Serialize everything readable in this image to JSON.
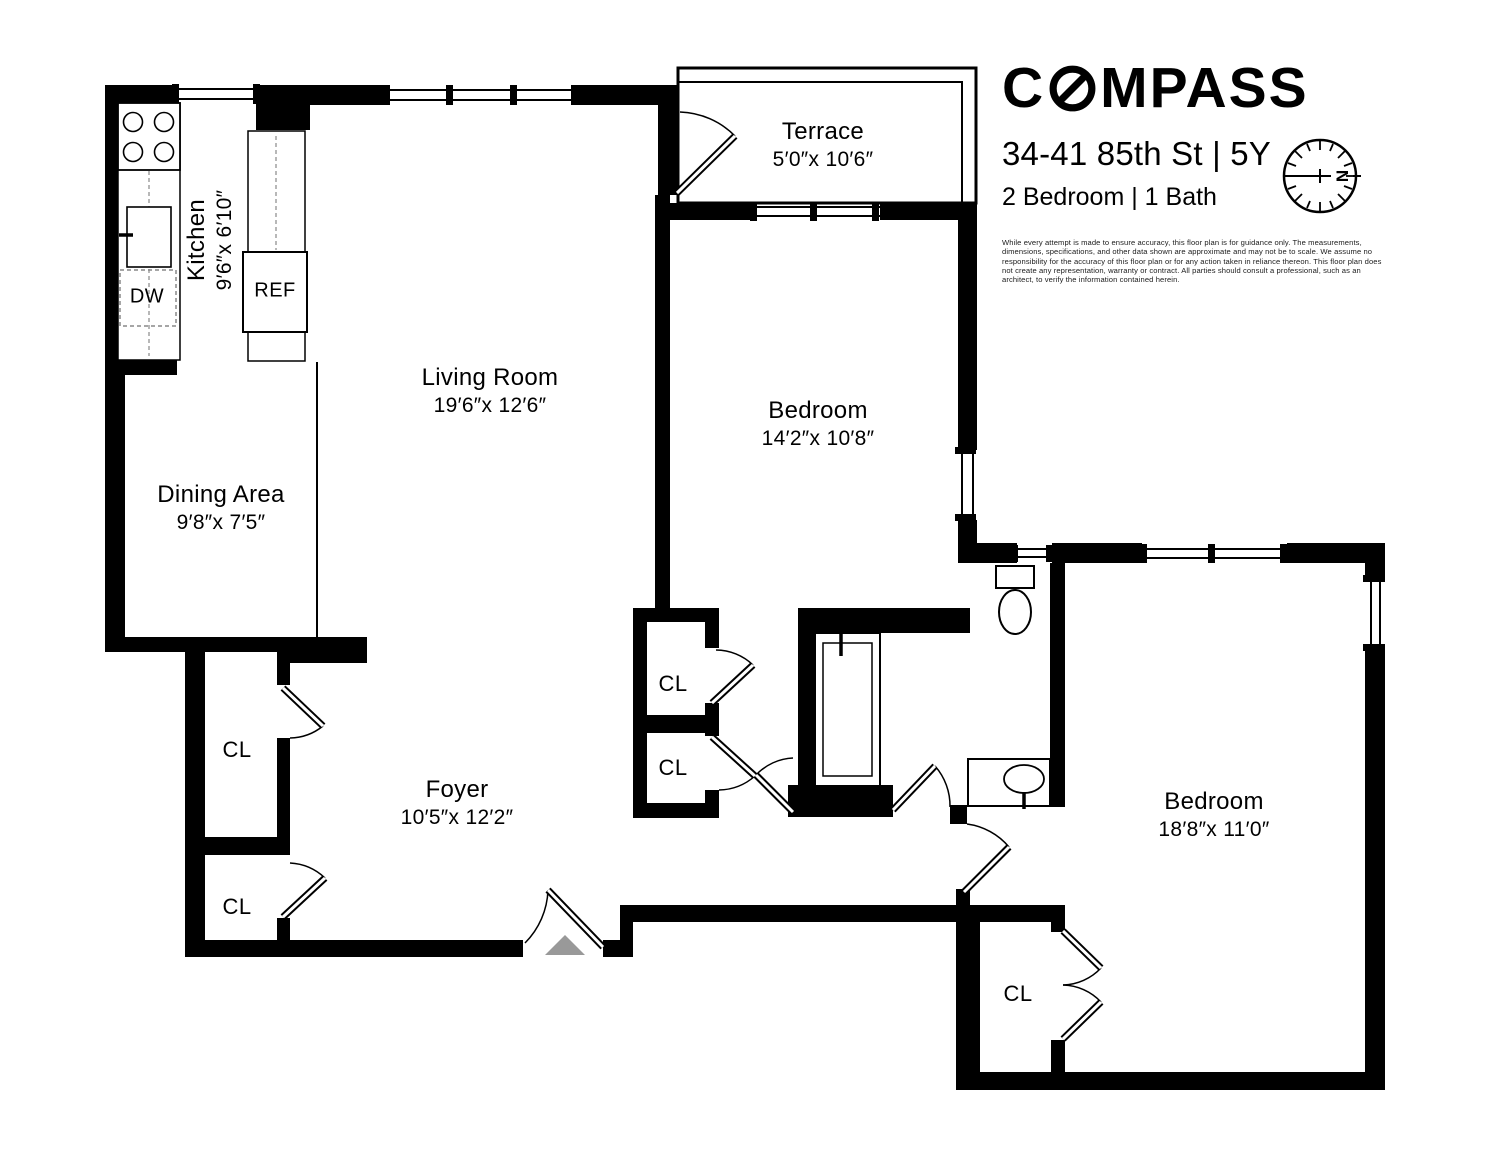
{
  "header": {
    "brand": {
      "pre_o": "C",
      "post_o": "MPASS"
    },
    "address": "34-41 85th St | 5Y",
    "summary": "2 Bedroom | 1 Bath",
    "compass_north_label": "N",
    "disclaimer": "While every attempt is made to ensure accuracy, this floor plan is for guidance only. The measurements, dimensions, specifications, and other data shown are approximate and may not be to scale. We assume no responsibility for the accuracy of this floor plan or for any action taken in reliance thereon. This floor plan does not create any representation, warranty or contract. All parties should consult a professional, such as an architect, to verify the information contained herein."
  },
  "rooms": [
    {
      "name": "Kitchen",
      "dims": "9′6″x 6′10″"
    },
    {
      "name": "Dining Area",
      "dims": "9′8″x 7′5″"
    },
    {
      "name": "Living Room",
      "dims": "19′6″x 12′6″"
    },
    {
      "name": "Terrace",
      "dims": "5′0″x 10′6″"
    },
    {
      "name": "Bedroom",
      "dims": "14′2″x 10′8″"
    },
    {
      "name": "Foyer",
      "dims": "10′5″x 12′2″"
    },
    {
      "name": "Bedroom",
      "dims": "18′8″x 11′0″"
    }
  ],
  "labels": {
    "dw": "DW",
    "ref": "REF",
    "cl": "CL"
  },
  "colors": {
    "wall": "#000000",
    "background": "#ffffff",
    "entry_marker": "#999999"
  }
}
